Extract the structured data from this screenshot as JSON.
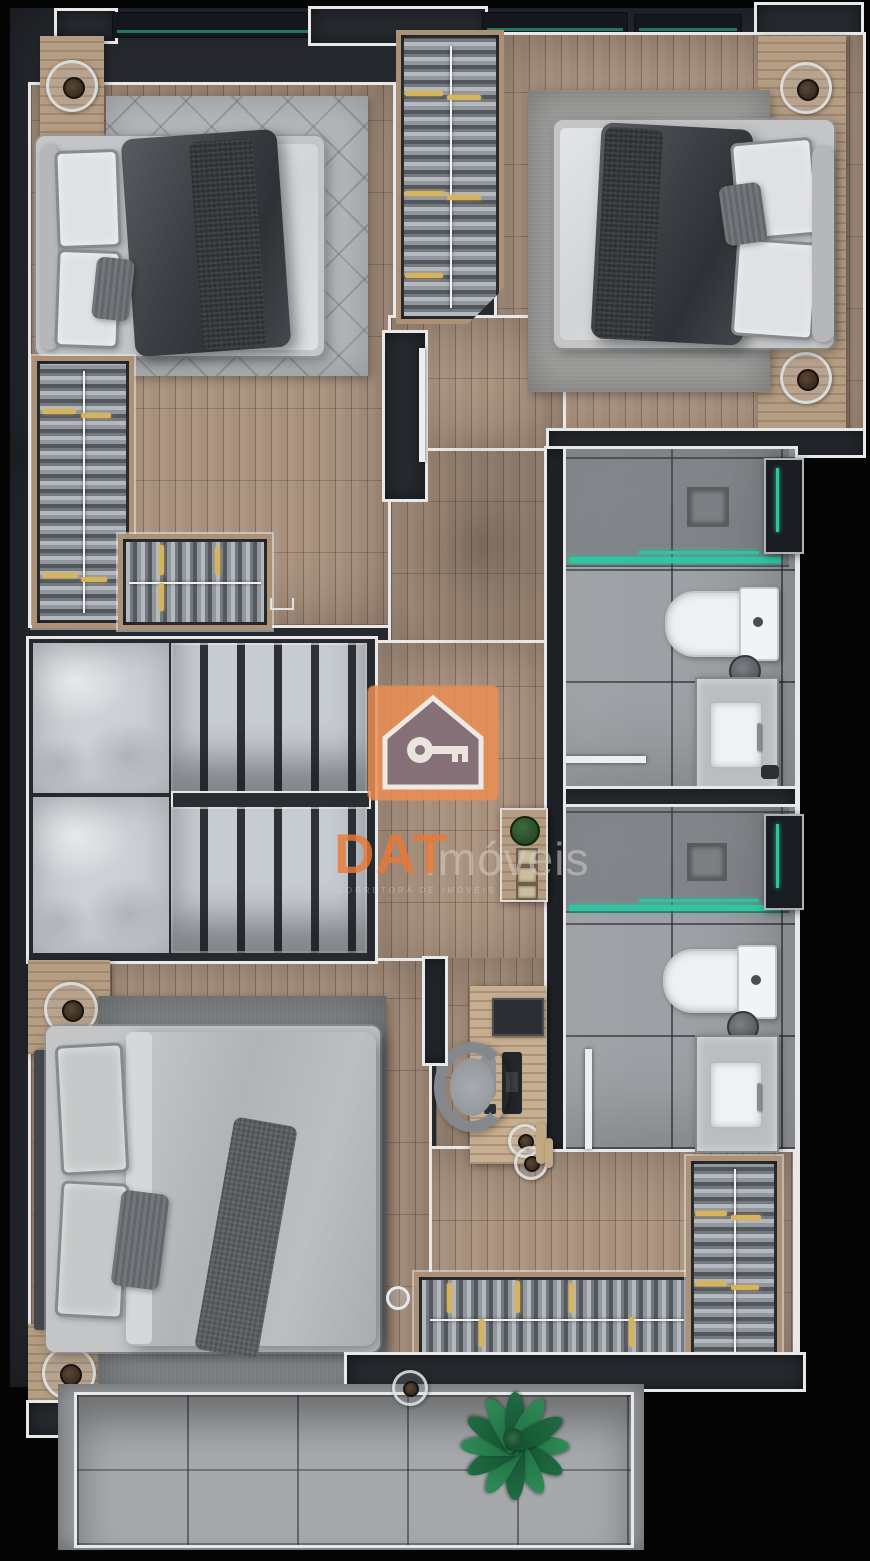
{
  "watermark": {
    "brand": "DAT",
    "brand_suffix": "Imóveis",
    "brand_sub": "CORRETORA DE IMÓVEIS",
    "logo_icon": "house-with-key-icon",
    "logo_square_color": "#eb8e53"
  },
  "colors": {
    "background": "#050505",
    "wall": "#262a2f",
    "trim": "#e8e8e8",
    "wood_floor": "#a8907d",
    "wood_furniture": "#b49d83",
    "tile": "#9da1a5",
    "marble": "#cdd1d6",
    "rug_light": "#b5b8ba",
    "rug_mid": "#9d9d9b",
    "rug_dark": "#808487",
    "duvet_dark": "#3f4347",
    "duvet_light": "#bcbec0",
    "linen_white": "#dfe1e3",
    "accent_teal": "#2cc6a0",
    "clothes_yellow": "#d6b45f",
    "plant_green": "#2f8b56",
    "watermark_orange": "#ea7834",
    "watermark_gray": "#d2cec8",
    "balcony_tile": "#a6a9ac"
  }
}
